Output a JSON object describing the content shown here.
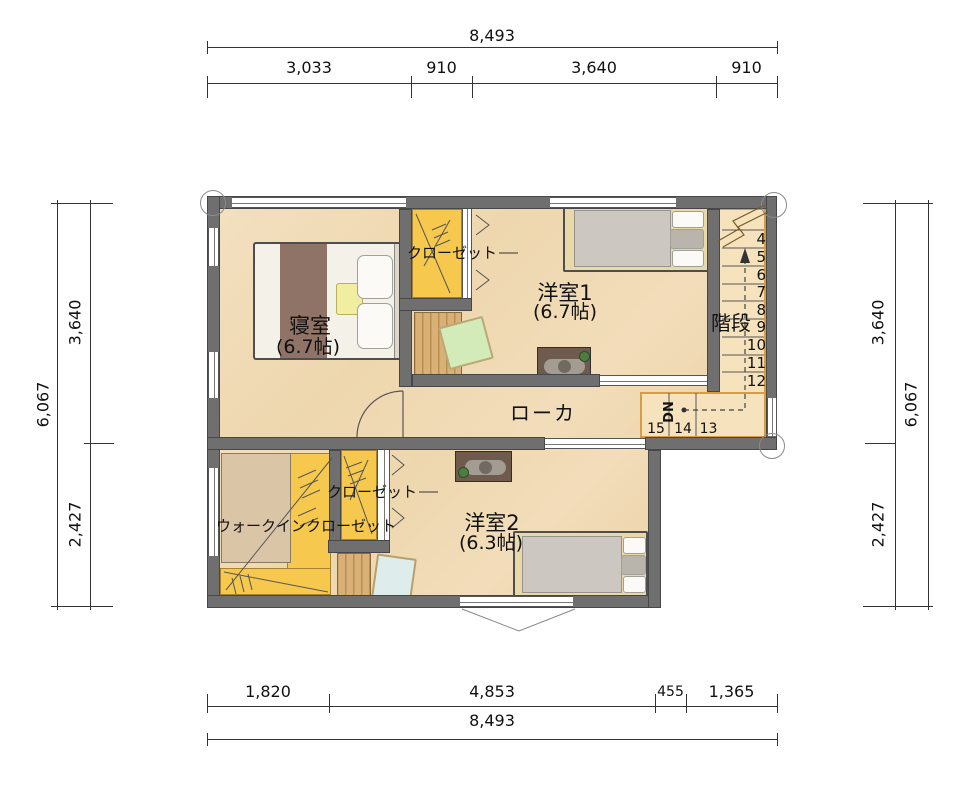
{
  "title": "2F間取り図",
  "dimensions": {
    "top": {
      "total": "8,493",
      "segments": [
        "3,033",
        "910",
        "3,640",
        "910"
      ]
    },
    "bottom": {
      "total": "8,493",
      "segments": [
        "1,820",
        "4,853",
        "455",
        "1,365"
      ]
    },
    "left": {
      "total": "6,067",
      "segments": [
        "3,640",
        "2,427"
      ]
    },
    "right": {
      "total": "6,067",
      "segments": [
        "3,640",
        "2,427"
      ]
    }
  },
  "rooms": {
    "bedroom": {
      "name": "寝室",
      "size": "(6.7帖)"
    },
    "western1": {
      "name": "洋室1",
      "size": "(6.7帖)"
    },
    "western2": {
      "name": "洋室2",
      "size": "(6.3帖)"
    },
    "corridor": {
      "name": "ローカ"
    },
    "stairs": {
      "name": "階段",
      "down": "DN"
    },
    "closet_top": {
      "name": "クローゼット"
    },
    "closet_lower": {
      "name": "クローゼット"
    },
    "walk_in_closet": {
      "name": "ウォークインクローゼット"
    }
  },
  "stair_numbers": {
    "flight": [
      "4",
      "5",
      "6",
      "7",
      "8",
      "9",
      "10",
      "11",
      "12"
    ],
    "landing": [
      "15",
      "14",
      "13"
    ]
  },
  "colors": {
    "floor": "#f1dbb6",
    "wall": "#6f6f6f",
    "closet_yellow": "#f6c94e",
    "stair_trim": "#d89c44",
    "wood": "#d9b177",
    "bed_runner": "#8f7366",
    "blanket_gray": "#ccc8c1",
    "cushion_green": "#d2ebb8",
    "chair_teal": "#dfecec"
  }
}
